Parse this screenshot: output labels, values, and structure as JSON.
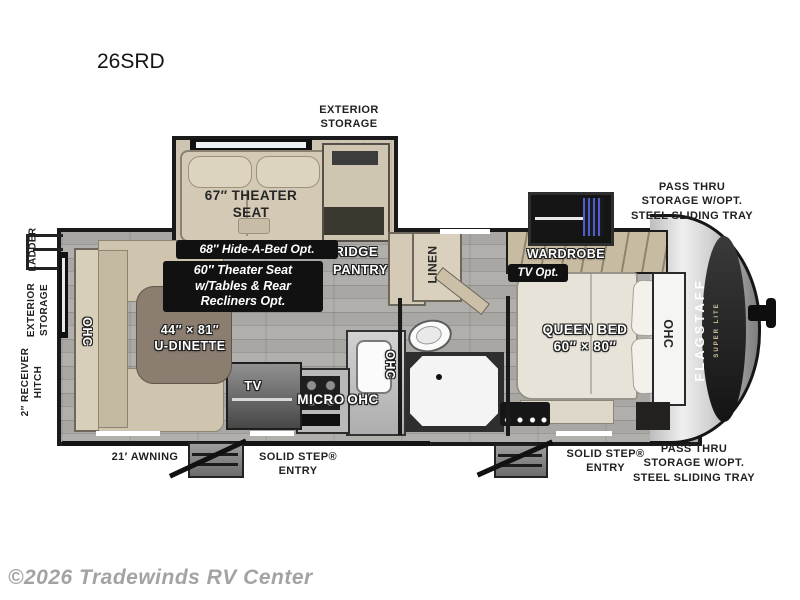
{
  "title": "26SRD",
  "watermark": "©2026 Tradewinds RV Center",
  "colors": {
    "wall": "#1a1a1a",
    "tag_bg": "#111111",
    "floor_gray": "#a2a19d",
    "slide_floor_beige": "#cdc3ae",
    "sliding_tray_blue": "#4d5fd0"
  },
  "exterior_labels": {
    "storage_top": "EXTERIOR\nSTORAGE",
    "pass_thru_top": "PASS THRU\nSTORAGE W/OPT.\nSTEEL SLIDING TRAY",
    "pass_thru_bottom": "PASS THRU\nSTORAGE W/OPT.\nSTEEL SLIDING TRAY",
    "awning": "21′ AWNING",
    "entry_main": "SOLID STEP®\nENTRY",
    "entry_bedroom": "SOLID STEP®\nENTRY",
    "ladder": "LADDER",
    "storage_side": "EXTERIOR\nSTORAGE",
    "hitch": "2″ RECEIVER\nHITCH"
  },
  "brand": {
    "name": "FLAGSTAFF",
    "sub": "SUPER LITE"
  },
  "rooms": {
    "theater_seat": "67″ THEATER\nSEAT",
    "fridge": "FRIDGE",
    "pantry": "PANTRY",
    "linen": "LINEN",
    "wardrobe": "WARDROBE",
    "queen_bed": "QUEEN BED\n60″ × 80″",
    "u_dinette": "44″ × 81″\nU-DINETTE",
    "tv": "TV",
    "micro": "MICRO",
    "ohc_kitchen": "OHC",
    "ohc_sink": "OHC",
    "ohc_dinette": "OHC",
    "ohc_bedroom": "OHC"
  },
  "options": {
    "hide_a_bed": "68″ Hide-A-Bed Opt.",
    "theater_seat_alt": "60″ Theater Seat\nw/Tables & Rear\nRecliners Opt.",
    "tv_opt": "TV Opt."
  }
}
